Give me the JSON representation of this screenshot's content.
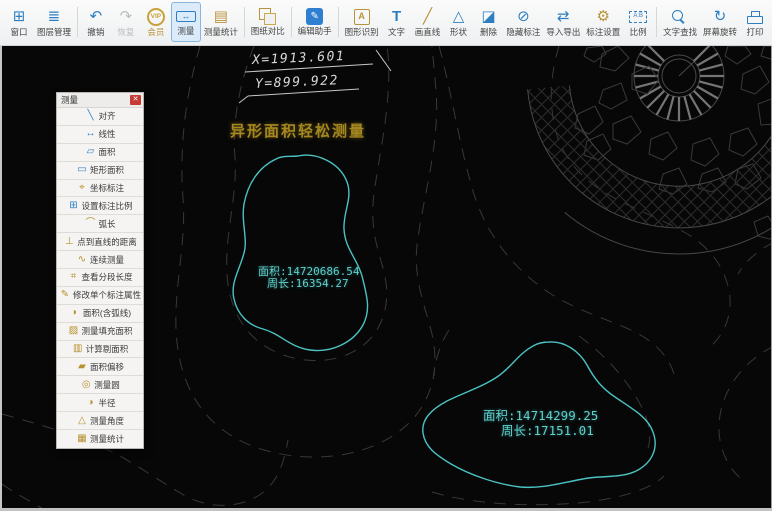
{
  "toolbar": {
    "items": [
      {
        "label": "窗口",
        "glyph": "⊞"
      },
      {
        "label": "图层管理",
        "glyph": "≣"
      },
      {
        "label": "撤销",
        "glyph": "↶"
      },
      {
        "label": "恢复",
        "glyph": "↷"
      },
      {
        "label": "会员",
        "glyph": "VIP"
      },
      {
        "label": "测量",
        "glyph": "↔"
      },
      {
        "label": "测量统计",
        "glyph": "▤"
      },
      {
        "label": "图纸对比",
        "glyph": ""
      },
      {
        "label": "编辑助手",
        "glyph": "✎"
      },
      {
        "label": "图形识别",
        "glyph": "A"
      },
      {
        "label": "文字",
        "glyph": "T"
      },
      {
        "label": "画直线",
        "glyph": "╱"
      },
      {
        "label": "形状",
        "glyph": "△"
      },
      {
        "label": "删除",
        "glyph": "◪"
      },
      {
        "label": "隐藏标注",
        "glyph": "⊘"
      },
      {
        "label": "导入导出",
        "glyph": "⇄"
      },
      {
        "label": "标注设置",
        "glyph": "⚙"
      },
      {
        "label": "比例",
        "glyph": "A:B"
      },
      {
        "label": "文字查找",
        "glyph": ""
      },
      {
        "label": "屏幕旋转",
        "glyph": "↻"
      },
      {
        "label": "打印",
        "glyph": ""
      }
    ]
  },
  "panel": {
    "title": "测量",
    "close_glyph": "✕",
    "items": [
      {
        "label": "对齐",
        "glyph": "╲"
      },
      {
        "label": "线性",
        "glyph": "↔"
      },
      {
        "label": "面积",
        "glyph": "▱"
      },
      {
        "label": "矩形面积",
        "glyph": "▭"
      },
      {
        "label": "坐标标注",
        "glyph": "⌖"
      },
      {
        "label": "设置标注比例",
        "glyph": "⊞"
      },
      {
        "label": "弧长",
        "glyph": "⌒"
      },
      {
        "label": "点到直线的距离",
        "glyph": "⊥"
      },
      {
        "label": "连续测量",
        "glyph": "∿"
      },
      {
        "label": "查看分段长度",
        "glyph": "⌗"
      },
      {
        "label": "修改单个标注属性",
        "glyph": "✎"
      },
      {
        "label": "面积(含弧线)",
        "glyph": "◗"
      },
      {
        "label": "测量填充面积",
        "glyph": "▨"
      },
      {
        "label": "计算剔面积",
        "glyph": "▥"
      },
      {
        "label": "面积偏移",
        "glyph": "▰"
      },
      {
        "label": "测量圆",
        "glyph": "◎"
      },
      {
        "label": "半径",
        "glyph": "◑"
      },
      {
        "label": "测量角度",
        "glyph": "△"
      },
      {
        "label": "测量统计",
        "glyph": "▦"
      }
    ]
  },
  "canvas": {
    "coord_x_label": "X=1913.601",
    "coord_y_label": "Y=899.922",
    "headline": "异形面积轻松测量",
    "shapes": [
      {
        "area_label": "面积:14720686.54",
        "perimeter_label": "周长:16354.27"
      },
      {
        "area_label": "面积:14714299.25",
        "perimeter_label": "周长:17151.01"
      }
    ],
    "colors": {
      "shape_stroke": "#4cc2c2",
      "measure_text": "#5ed0ca",
      "headline_text": "#a5871f",
      "contour_line": "#383838",
      "dimension_text": "#d8d8d8",
      "toolbar_blue": "#2e7fc1",
      "toolbar_gold": "#b8933a"
    }
  }
}
